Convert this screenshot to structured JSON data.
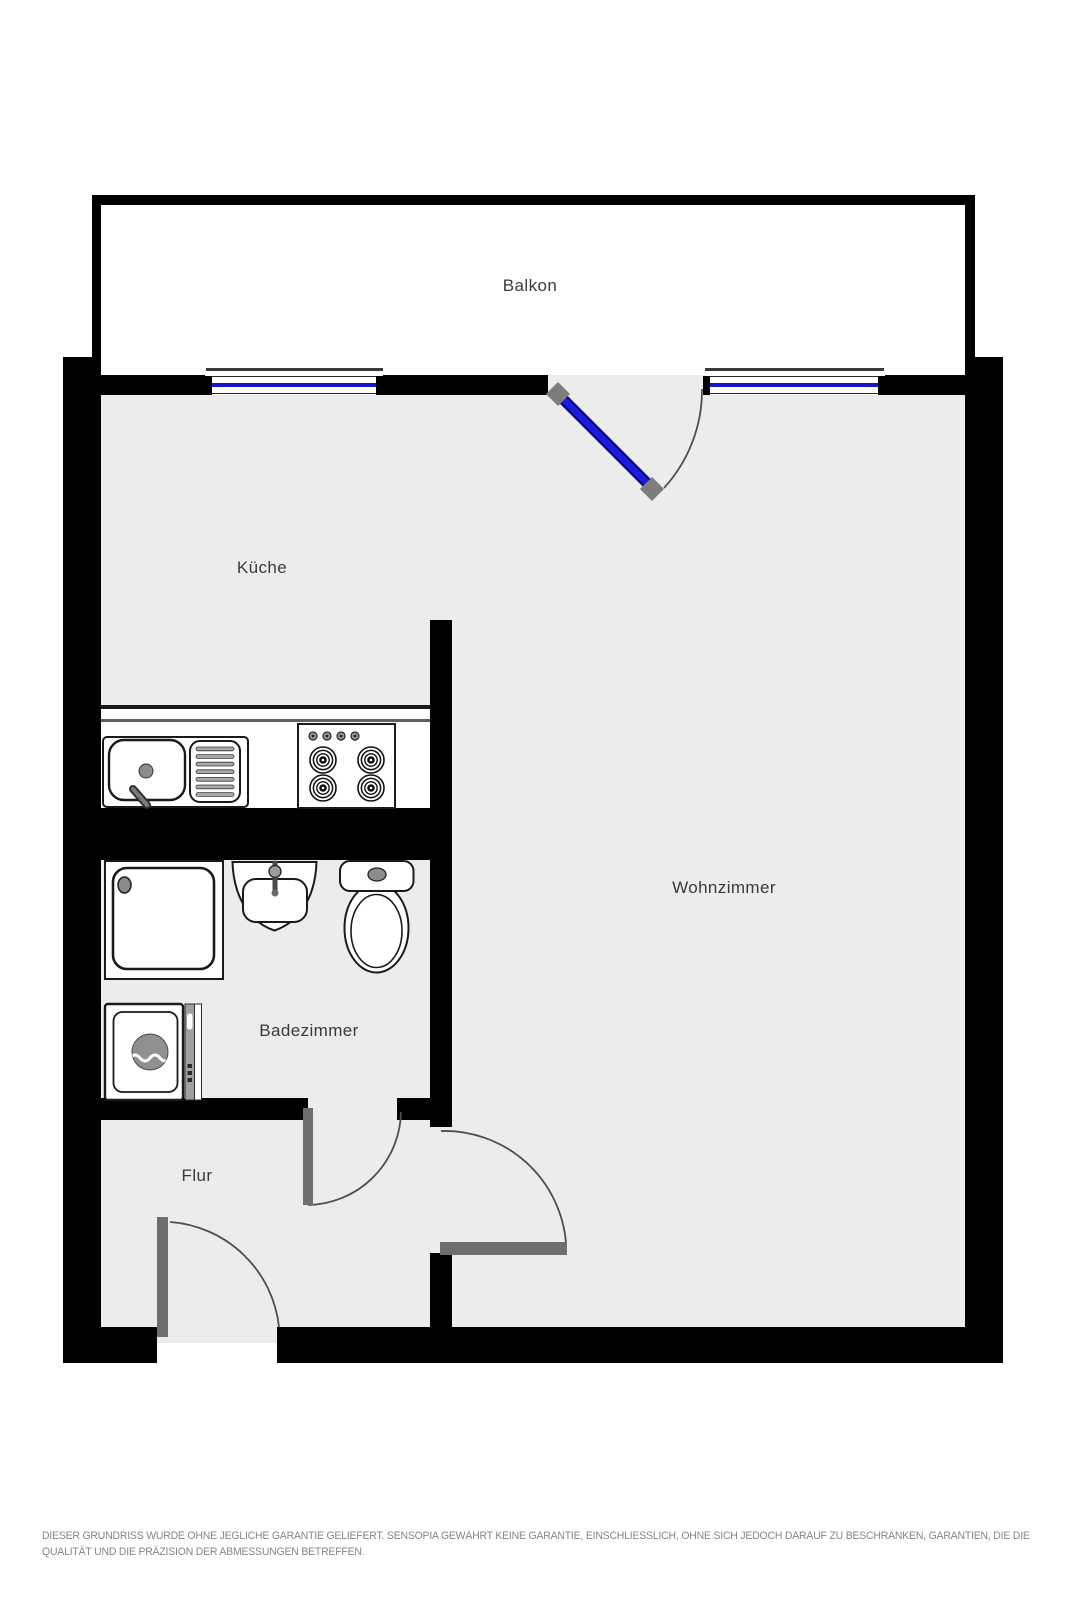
{
  "meta": {
    "canvas_width": 1067,
    "canvas_height": 1600,
    "type": "apartment-floor-plan"
  },
  "colors": {
    "wall": "#000000",
    "floor": "#ececec",
    "balcony_floor": "#ffffff",
    "window_glass": "#1518cc",
    "balcony_door_glass": "#1d1dd8",
    "balcony_door_edge": "#00008b",
    "door_leaf": "#6e6e6e",
    "hinge_block": "#7d7d7d",
    "fixture_outline": "#1a1a1a",
    "fixture_gray": "#8c8c8c",
    "label_text": "#3a3a3a",
    "disclaimer_text": "#858585"
  },
  "rooms": [
    {
      "id": "balkon",
      "label": "Balkon"
    },
    {
      "id": "kueche",
      "label": "Küche"
    },
    {
      "id": "wohnzimmer",
      "label": "Wohnzimmer"
    },
    {
      "id": "badezimmer",
      "label": "Badezimmer"
    },
    {
      "id": "flur",
      "label": "Flur"
    }
  ],
  "fixtures": [
    "kitchen-counter",
    "kitchen-sink",
    "drainboard",
    "stove-4-burners",
    "shower",
    "bathroom-sink",
    "toilet",
    "washing-machine"
  ],
  "doors": [
    {
      "id": "balcony-door",
      "type": "glass-swing"
    },
    {
      "id": "bathroom-door",
      "type": "swing"
    },
    {
      "id": "living-room-door",
      "type": "swing"
    },
    {
      "id": "entrance-door",
      "type": "swing"
    }
  ],
  "windows": [
    {
      "id": "kitchen-window"
    },
    {
      "id": "living-room-window"
    }
  ],
  "disclaimer": {
    "line1": "DIESER GRUNDRISS WURDE OHNE JEGLICHE GARANTIE GELIEFERT. SENSOPIA GEWÄHRT KEINE GARANTIE, EINSCHLIESSLICH, OHNE SICH JEDOCH DARAUF ZU BESCHRÄNKEN, GARANTIEN, DIE DIE",
    "line2": "QUALITÄT UND DIE PRÄZISION DER ABMESSUNGEN BETREFFEN."
  }
}
